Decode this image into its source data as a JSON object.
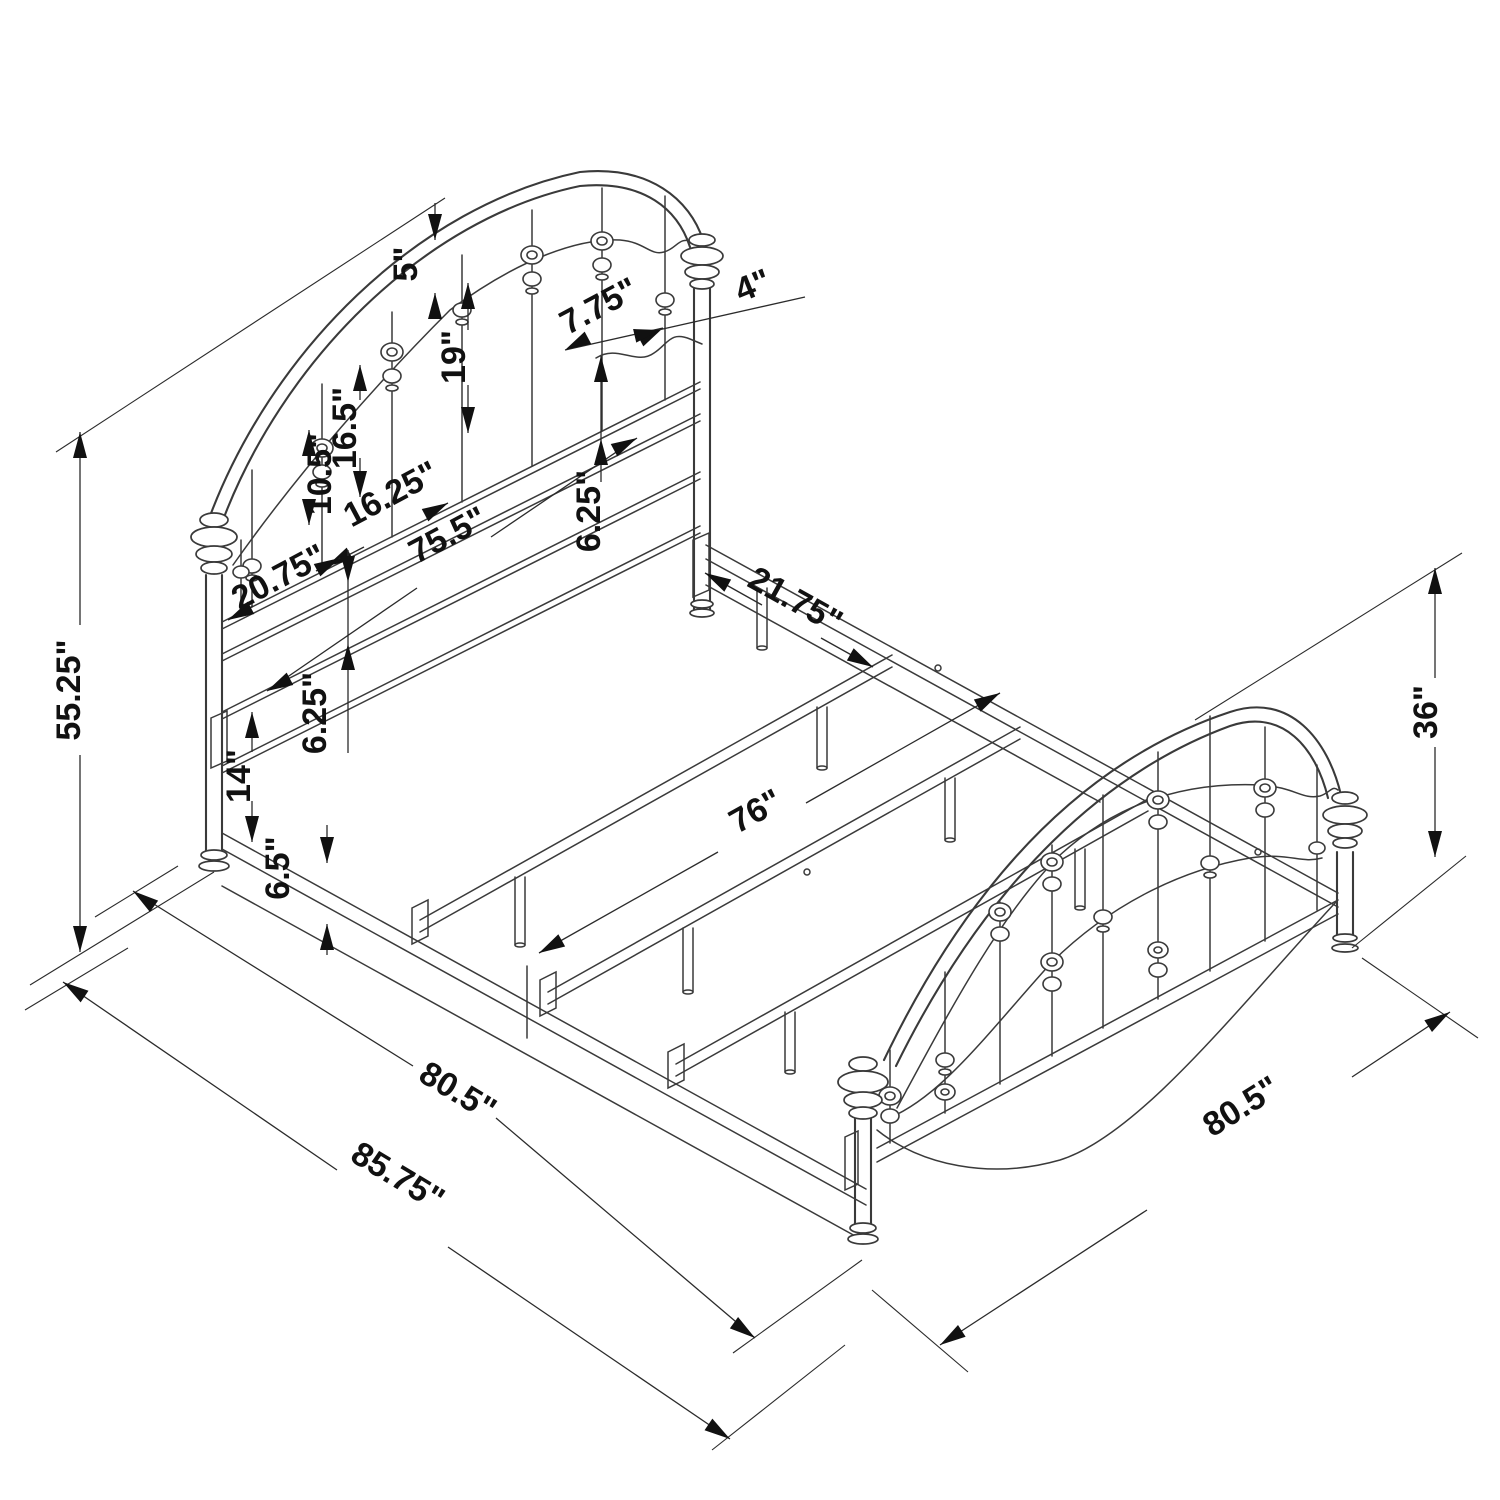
{
  "figure": {
    "type": "technical-line-drawing",
    "subject": "metal bed frame isometric dimension diagram",
    "background_color": "#ffffff",
    "line_color": "#3a3a3a",
    "text_color": "#111111"
  },
  "dimensions": {
    "headboard_height": "55.25\"",
    "arch_rail_gap": "5\"",
    "long_spindle": "19\"",
    "mid_spindle": "16.5\"",
    "short_spindle": "10.5\"",
    "spindle_spread": "16.25\"",
    "headboard_inner_width": "75.5\"",
    "headboard_lower_section": "20.75\"",
    "spindle_gap": "7.75\"",
    "post_spindle_gap": "4\"",
    "upper_bar_gap": "6.25\"",
    "lower_bar_gap": "6.25\"",
    "post_lower_section": "14\"",
    "rail_floor_clearance": "6.5\"",
    "slat_spacing": "21.75\"",
    "slat_length": "76\"",
    "footboard_height": "36\"",
    "frame_length": "80.5\"",
    "overall_length": "85.75\"",
    "footboard_width": "80.5\""
  }
}
